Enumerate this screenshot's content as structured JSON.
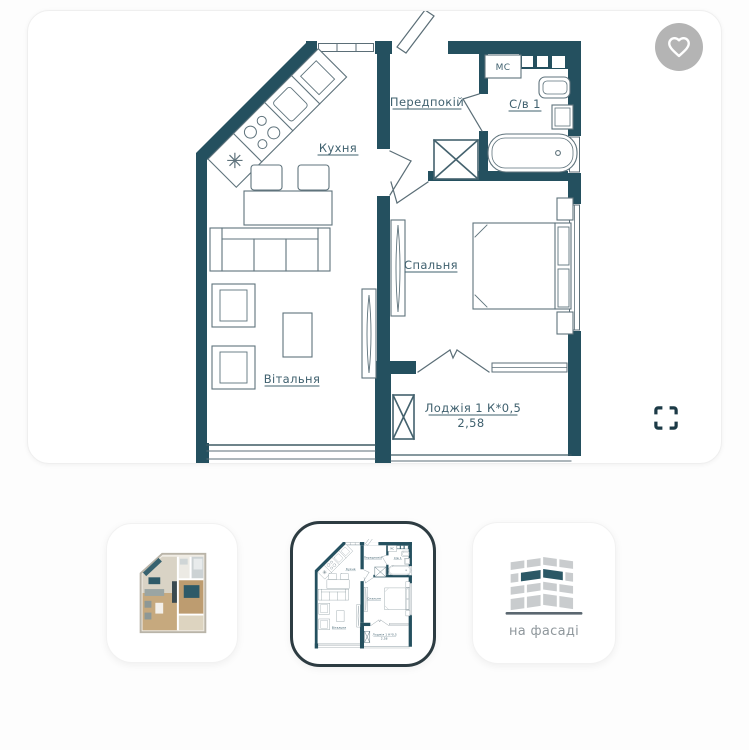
{
  "viewer": {
    "favorite_icon": "heart",
    "fullscreen_icon": "expand-corners"
  },
  "floorplan": {
    "labels": {
      "kitchen": "Кухня",
      "hallway": "Передпокій",
      "bathroom": "С/в 1",
      "bedroom": "Спальня",
      "living_room": "Вітальня",
      "loggia": "Лоджія 1  К*0,5",
      "loggia_area": "2,58",
      "washing_machine": "МС"
    },
    "colors": {
      "walls": "#24505f",
      "furniture_lines": "#5f737c",
      "label_text": "#3f606e"
    }
  },
  "thumbnails": {
    "items": [
      {
        "id": "3d-plan",
        "selected": false,
        "label": ""
      },
      {
        "id": "2d-plan",
        "selected": true,
        "label": ""
      },
      {
        "id": "facade",
        "selected": false,
        "label": "на фасаді"
      }
    ]
  }
}
